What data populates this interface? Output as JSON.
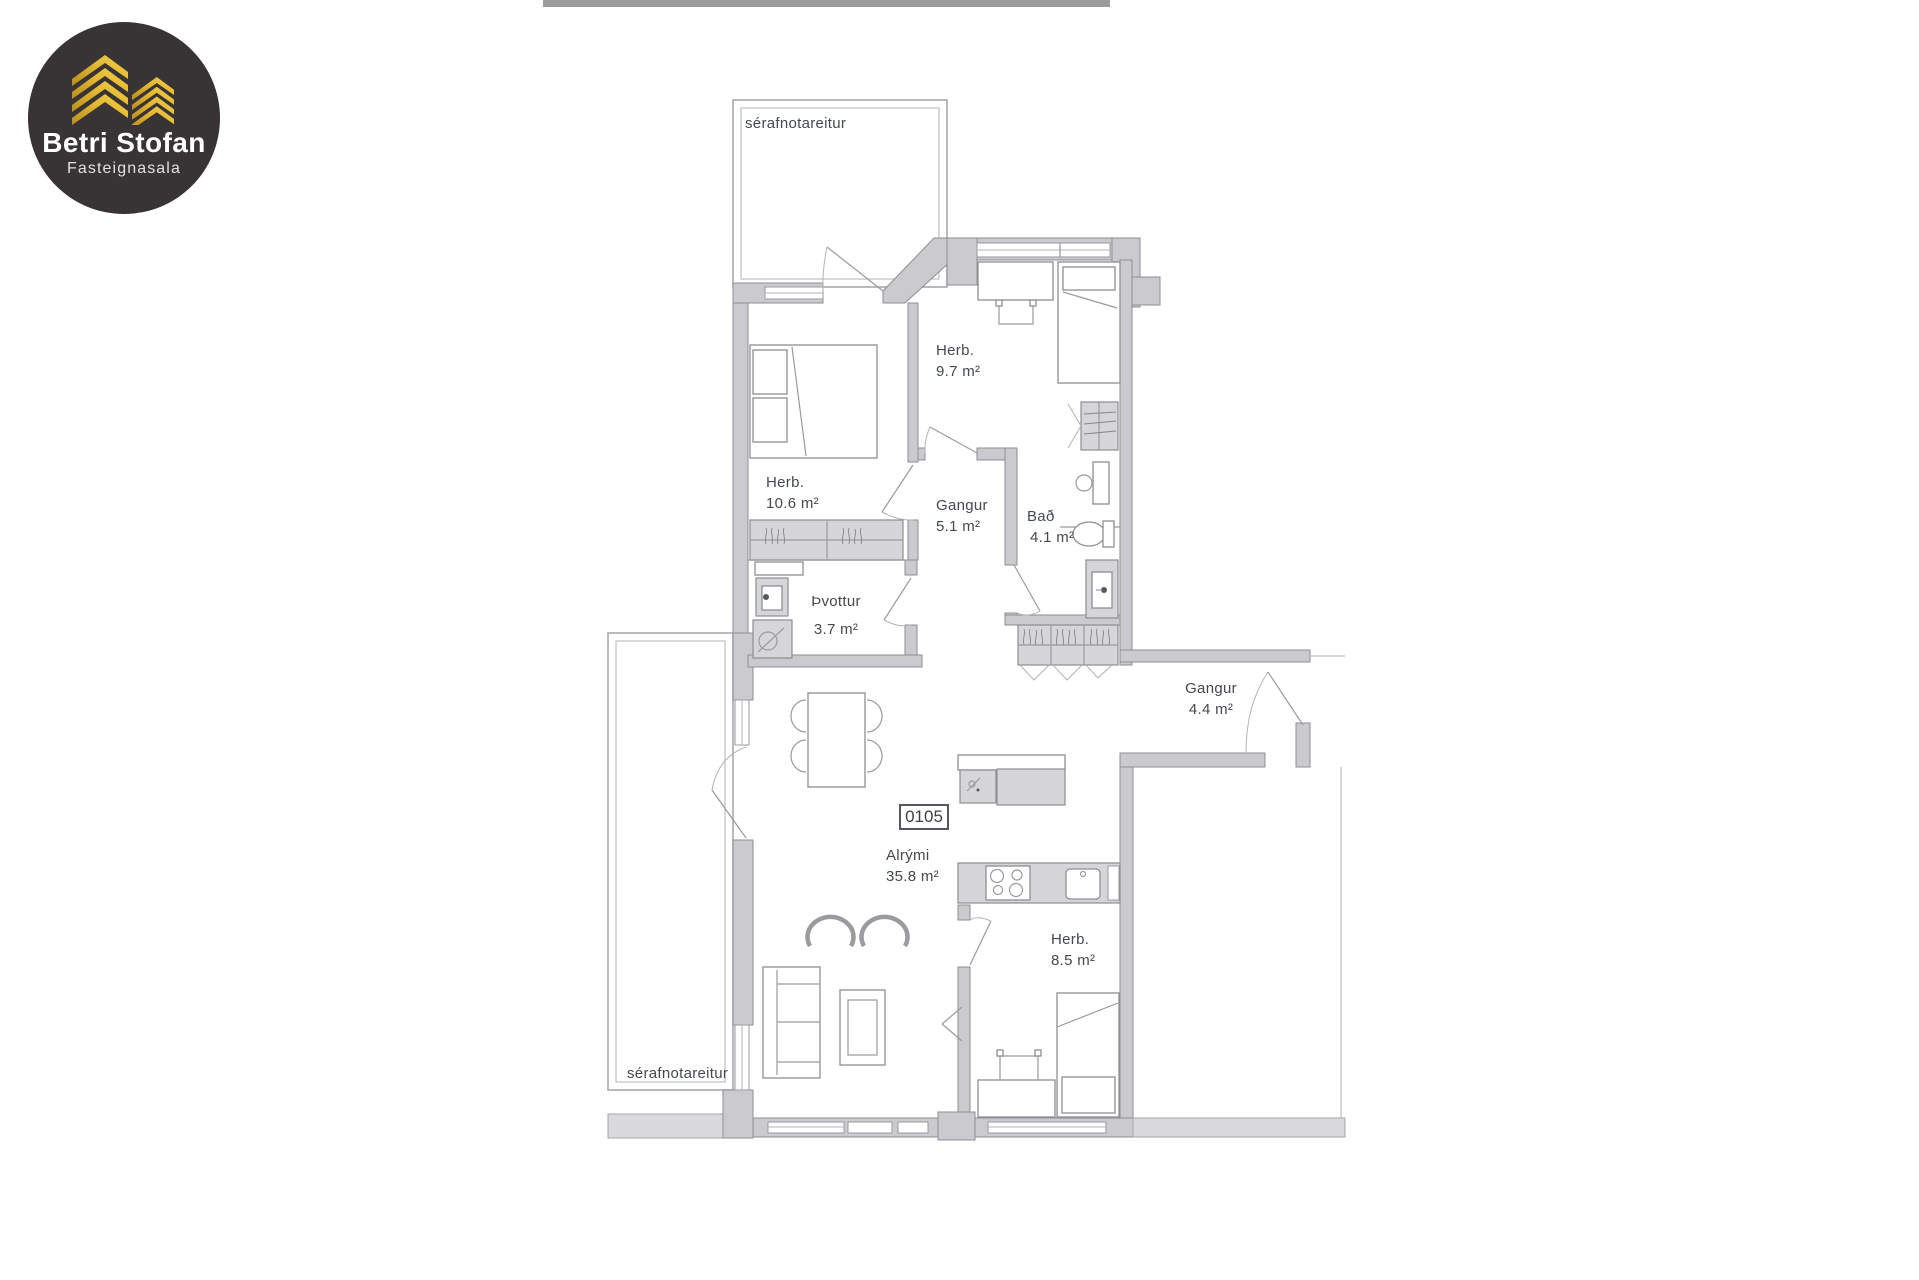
{
  "logo": {
    "brand": "Betri Stofan",
    "tagline": "Fasteignasala",
    "background": "#383334",
    "gold": "#d9ab2e"
  },
  "plan": {
    "unit_number": "0105",
    "rooms": [
      {
        "id": "serafnotareitur-top",
        "name": "sérafnotareitur",
        "area": ""
      },
      {
        "id": "herb-10-6",
        "name": "Herb.",
        "area": "10.6 m²"
      },
      {
        "id": "herb-9-7",
        "name": "Herb.",
        "area": "9.7 m²"
      },
      {
        "id": "gangur-5-1",
        "name": "Gangur",
        "area": "5.1 m²"
      },
      {
        "id": "bad-4-1",
        "name": "Bað",
        "area": "4.1 m²"
      },
      {
        "id": "thvottur-3-7",
        "name": "Þvottur",
        "area": "3.7 m²"
      },
      {
        "id": "gangur-4-4",
        "name": "Gangur",
        "area": "4.4 m²"
      },
      {
        "id": "alrymi-35-8",
        "name": "Alrými",
        "area": "35.8 m²"
      },
      {
        "id": "herb-8-5",
        "name": "Herb.",
        "area": "8.5 m²"
      },
      {
        "id": "serafnotareitur-bottom",
        "name": "sérafnotareitur",
        "area": ""
      }
    ]
  },
  "colors": {
    "wall": "#cbcbcf",
    "text": "#45494e",
    "top_bar": "#9b9b9b"
  }
}
